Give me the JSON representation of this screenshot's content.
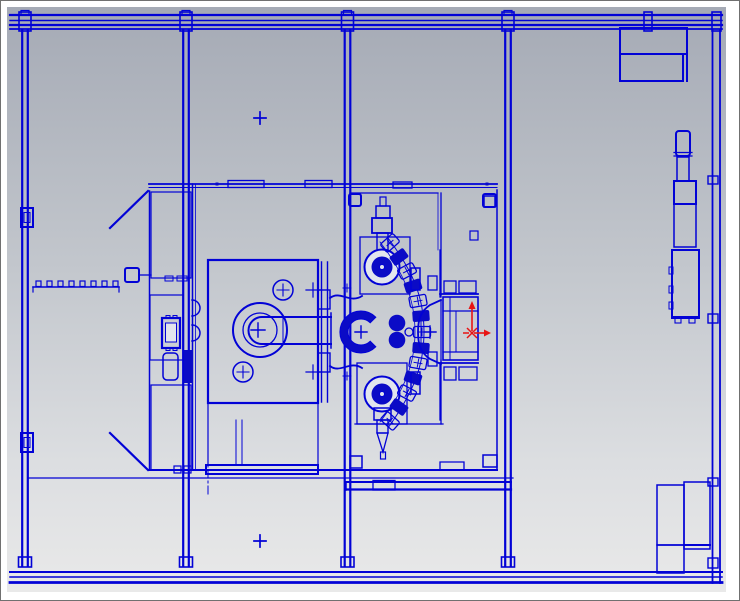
{
  "scene": {
    "type": "cad-2d-drawing-viewport",
    "subject": "machining-center-top-view",
    "visible_text": "none"
  },
  "colors": {
    "line_blue": "#0202d6",
    "dark_blue_fill": "#0b0bc6",
    "origin_red": "#e81414",
    "bg_top": "#a5aab5",
    "bg_upper_mid": "#c3c7cd",
    "bg_lower_mid": "#dcdee1",
    "bg_bottom": "#e9e9e9",
    "margin_white": "#ffffff",
    "border_gray": "#707070"
  },
  "frame": {
    "beam_centers_x": [
      25,
      186,
      347.5,
      508
    ],
    "right_rail_x": [
      712.5,
      720
    ],
    "top_rail_y": [
      15,
      20.5,
      25,
      29
    ],
    "bottom_rail_y": [
      572,
      577,
      582.5
    ],
    "rail_x_start": 10,
    "rail_x_end": 722
  },
  "origin_triad": {
    "x": 472,
    "y": 333
  },
  "reference_crosses": [
    {
      "x": 260,
      "y": 118
    },
    {
      "x": 260,
      "y": 541
    }
  ],
  "tool_chain": {
    "pods": [
      {
        "x": 390,
        "y": 243,
        "a": -42,
        "dark": false
      },
      {
        "x": 399,
        "y": 257,
        "a": -36,
        "dark": true
      },
      {
        "x": 407,
        "y": 271,
        "a": -28,
        "dark": false
      },
      {
        "x": 413,
        "y": 286,
        "a": -18,
        "dark": true
      },
      {
        "x": 418,
        "y": 301,
        "a": -10,
        "dark": false
      },
      {
        "x": 421,
        "y": 316,
        "a": -4,
        "dark": true
      },
      {
        "x": 422,
        "y": 332,
        "a": 0,
        "dark": false
      },
      {
        "x": 421,
        "y": 348,
        "a": 4,
        "dark": true
      },
      {
        "x": 418,
        "y": 363,
        "a": 10,
        "dark": false
      },
      {
        "x": 413,
        "y": 378,
        "a": 18,
        "dark": true
      },
      {
        "x": 407,
        "y": 393,
        "a": 28,
        "dark": false
      },
      {
        "x": 399,
        "y": 407,
        "a": 36,
        "dark": true
      },
      {
        "x": 390,
        "y": 421,
        "a": 42,
        "dark": false
      }
    ]
  },
  "clamp_strip": {
    "y": 287,
    "x_start": 33,
    "x_end": 119,
    "tabs": [
      36,
      47,
      58,
      69,
      80,
      91,
      102,
      113
    ]
  }
}
